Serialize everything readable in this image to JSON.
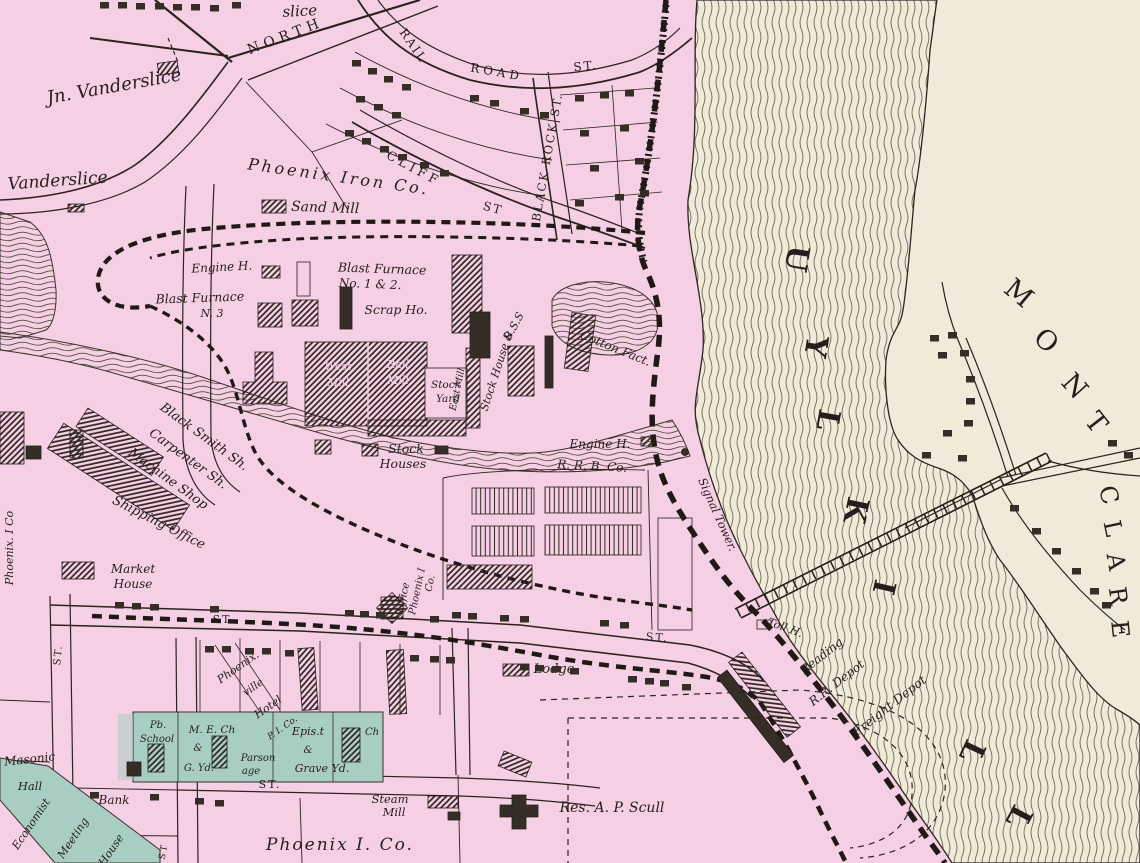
{
  "colors": {
    "land": "#f5cfe3",
    "water_paper": "#f0ead9",
    "teal_highlight": "#a8cdc2",
    "ink": "#241f1b"
  },
  "streets": {
    "north": "NORTH",
    "rail": "RAIL",
    "road": "ROAD",
    "railroad_st": "ST.",
    "black_rock": "BLACK ROCK ST.",
    "cliff": "CLIFF",
    "cliff_st": "ST",
    "st1": "ST.",
    "st2": "ST.",
    "st3": "ST.",
    "st4": "ST.",
    "st5": "ST"
  },
  "labels": {
    "slice": "slice",
    "jn_vanderslice": "Jn. Vanderslice",
    "vanderslice": "Vanderslice",
    "phoenix_iron_co": "Phoenix Iron Co.",
    "sand_mill": "Sand Mill",
    "engine_h_1": "Engine H.",
    "blast_12_1": "Blast Furnace",
    "blast_12_2": "No. 1 & 2.",
    "scrap_ho": "Scrap Ho.",
    "blast_3_1": "Blast Furnace",
    "blast_3_2": "N. 3",
    "west_mill_1": "West",
    "west_mill_2": "Mill",
    "rail_mill_1": "Rail",
    "rail_mill_2": "Mill",
    "stock_yard_1": "Stock",
    "stock_yard_2": "Yard",
    "east_mill": "East Mill",
    "stock_house_1": "Stock House &",
    "stock_house_2": "B.S.S",
    "black_smith": "Black Smith Sh.",
    "carpenter": "Carpenter Sh.",
    "machine_shop": "Machine Shop",
    "stock_houses_1": "Stock",
    "stock_houses_2": "Houses",
    "cotton_fact": "Cotton Fact.",
    "engine_h_2": "Engine H.",
    "rrb_co": "R. R. B. Co.",
    "signal_tower": "Signal Tower.",
    "shipping_office": "Shipping Office",
    "market_house_1": "Market",
    "market_house_2": "House",
    "office_1": "Office",
    "office_2": "Phoenix I",
    "office_3": "Co.",
    "phoenix_i_co_w": "Phoenix. I Co",
    "toll_h": "Toll H.",
    "reading_1": "Reading",
    "reading_2": "R.R. Depot",
    "freight_depot": "Freight Depot",
    "lodge": "Lodge",
    "res_scull": "Res. A. P. Scull",
    "hotel_1": "Phoenix.",
    "hotel_2": "ville",
    "hotel_3": "Hotel",
    "hotel_4": "P. I. Co.",
    "masonic_1": "Masonic",
    "masonic_2": "Hall",
    "economist_1": "Economist",
    "economist_2": "Meeting",
    "economist_3": "House",
    "school_1": "Pb.",
    "school_2": "School",
    "me_ch_1": "M. E. Ch",
    "me_ch_2": "&",
    "me_ch_3": "G. Yd.",
    "parsonage_1": "Parson",
    "parsonage_2": "age",
    "epis_1": "Epis.t",
    "epis_2": "&",
    "epis_3": "Grave Yd.",
    "epis_ch": "Ch",
    "bank": "Bank",
    "steam_mill_1": "Steam",
    "steam_mill_2": "Mill",
    "phoenix_i_co_s": "Phoenix I. Co."
  },
  "river": {
    "visible": "UYLKILL"
  },
  "mont_clare": {
    "mont": "MONT",
    "clare": "CLARE"
  }
}
